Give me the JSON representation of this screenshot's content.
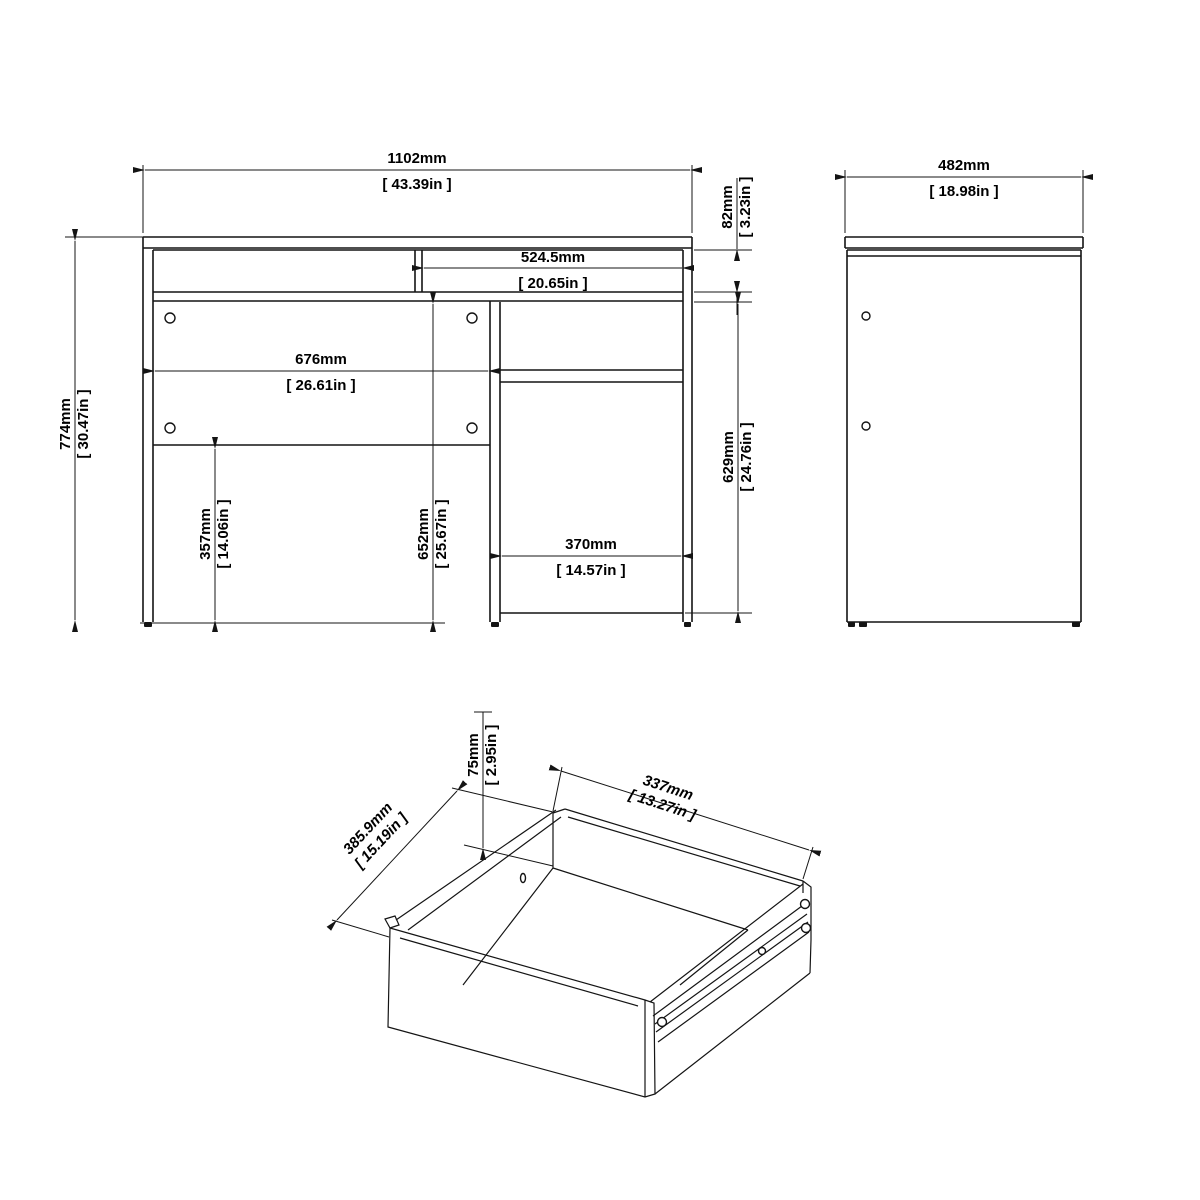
{
  "dims": {
    "overall_width": {
      "mm": "1102mm",
      "inch": "[ 43.39in ]"
    },
    "top_section": {
      "mm": "82mm",
      "inch": "[ 3.23in ]"
    },
    "shelf_opening": {
      "mm": "524.5mm",
      "inch": "[ 20.65in ]"
    },
    "back_panel": {
      "mm": "676mm",
      "inch": "[ 26.61in ]"
    },
    "overall_height": {
      "mm": "774mm",
      "inch": "[ 30.47in ]"
    },
    "leg_clearance": {
      "mm": "357mm",
      "inch": "[ 14.06in ]"
    },
    "under_top": {
      "mm": "652mm",
      "inch": "[ 25.67in ]"
    },
    "cabinet_height": {
      "mm": "629mm",
      "inch": "[ 24.76in ]"
    },
    "door_width": {
      "mm": "370mm",
      "inch": "[ 14.57in ]"
    },
    "side_depth": {
      "mm": "482mm",
      "inch": "[ 18.98in ]"
    },
    "drawer_height": {
      "mm": "75mm",
      "inch": "[ 2.95in ]"
    },
    "drawer_width": {
      "mm": "337mm",
      "inch": "[ 13.27in ]"
    },
    "drawer_depth": {
      "mm": "385.9mm",
      "inch": "[ 15.19in ]"
    }
  },
  "colors": {
    "line": "#141414",
    "background": "#ffffff"
  }
}
